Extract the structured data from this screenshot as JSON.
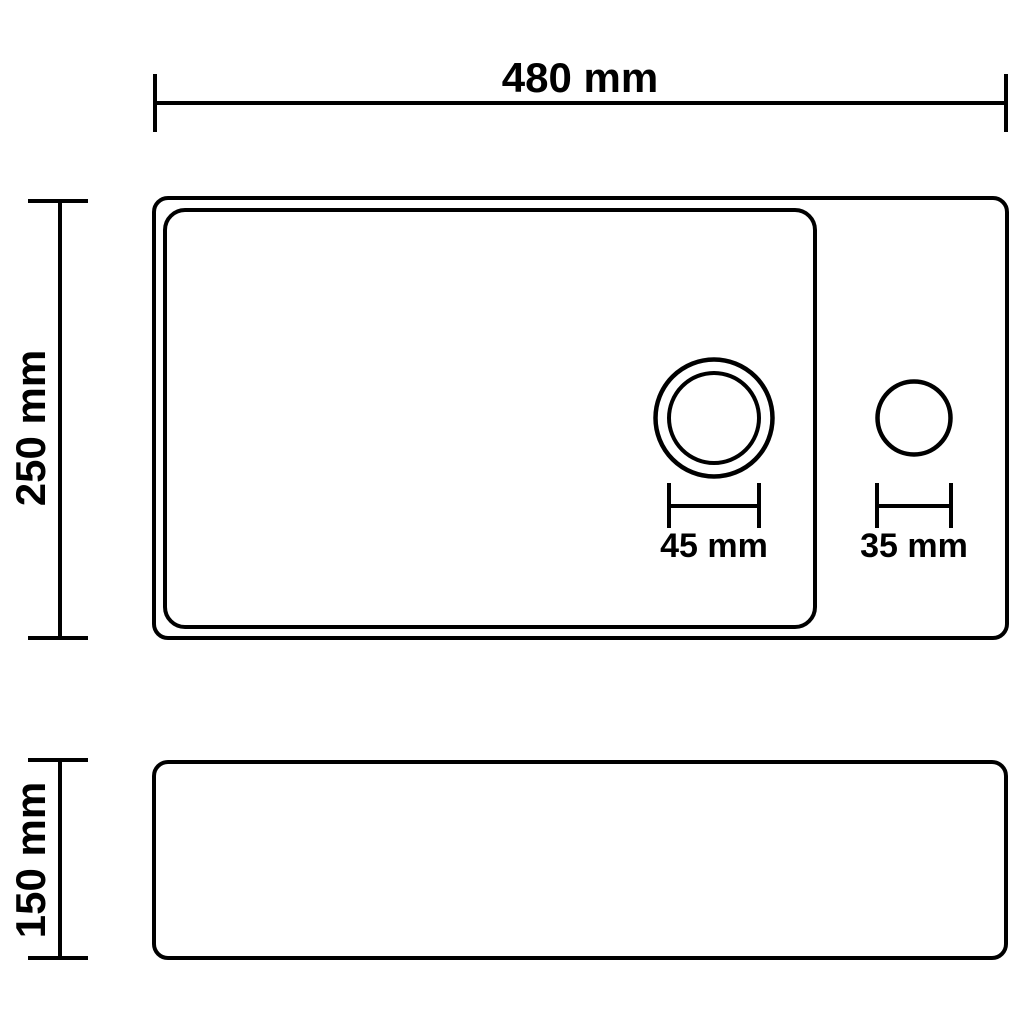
{
  "canvas": {
    "background": "#ffffff",
    "line_color": "#000000",
    "text_color": "#000000"
  },
  "drawing": {
    "kind": "technical-dimension-drawing",
    "views": [
      "top-view-plan",
      "side-view-profile"
    ]
  },
  "dimensions": {
    "overall_width": {
      "label": "480 mm",
      "value_mm": 480
    },
    "top_view_depth": {
      "label": "250 mm",
      "value_mm": 250
    },
    "drain_hole_diameter": {
      "label": "45 mm",
      "value_mm": 45
    },
    "faucet_hole_diameter": {
      "label": "35 mm",
      "value_mm": 35
    },
    "side_view_height": {
      "label": "150 mm",
      "value_mm": 150
    }
  }
}
